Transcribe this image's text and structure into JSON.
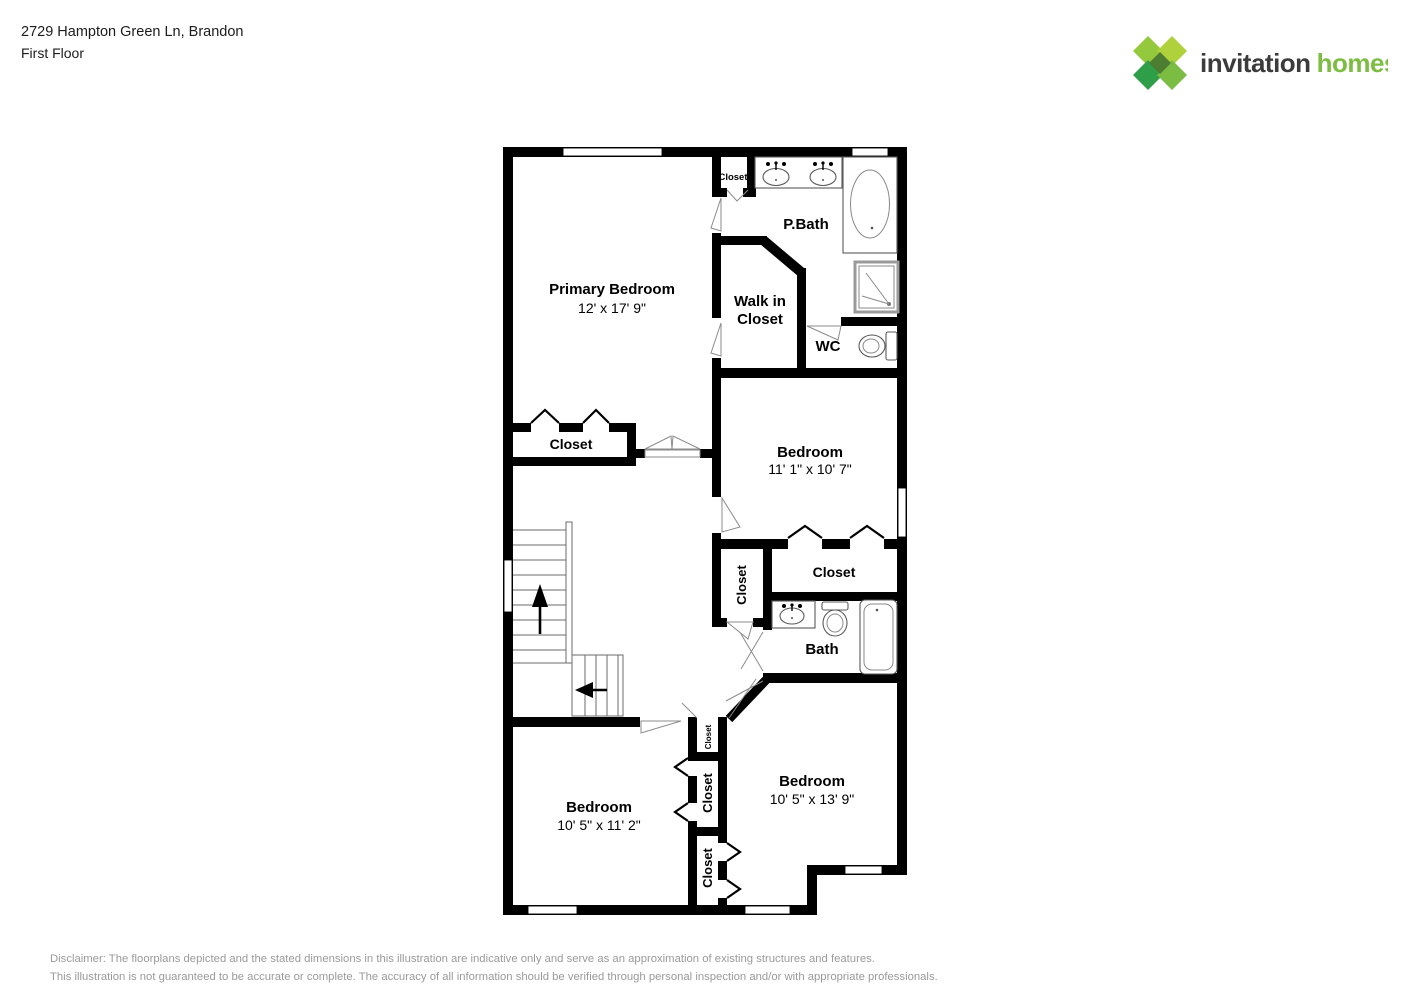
{
  "header": {
    "address": "2729 Hampton Green Ln, Brandon",
    "floor": "First Floor"
  },
  "logo": {
    "word1": "invitation",
    "word2": "homes",
    "trademark": "™",
    "colors": {
      "green_dark": "#2F9E48",
      "green_mid": "#7BBC42",
      "green_light": "#95C93D",
      "green_lighter": "#AFD13C",
      "green_center": "#4D7D31",
      "text_dark": "#3C3C3B"
    }
  },
  "floorplan": {
    "rooms": {
      "primary": {
        "name": "Primary Bedroom",
        "dims": "12' x 17' 9\""
      },
      "pbath": {
        "name": "P.Bath"
      },
      "walkin": {
        "line1": "Walk in",
        "line2": "Closet"
      },
      "wc": {
        "name": "WC"
      },
      "bedroom2": {
        "name": "Bedroom",
        "dims": "11' 1\" x 10' 7\""
      },
      "bath": {
        "name": "Bath"
      },
      "bedroom3": {
        "name": "Bedroom",
        "dims": "10' 5\" x 11' 2\""
      },
      "bedroom4": {
        "name": "Bedroom",
        "dims": "10' 5\" x 13' 9\""
      }
    },
    "closets": {
      "top": "Closet",
      "primary": "Closet",
      "bedroom2": "Closet",
      "hall": "Closet",
      "tiny": "Closet",
      "middle": "Closet",
      "bottom": "Closet"
    }
  },
  "disclaimer": {
    "line1": "Disclaimer: The floorplans depicted and the stated dimensions in this illustration are indicative only and serve as an approximation of existing structures and features.",
    "line2": "This illustration is not guaranteed to be accurate or complete. The accuracy of all information should be verified through personal inspection and/or with appropriate professionals."
  }
}
